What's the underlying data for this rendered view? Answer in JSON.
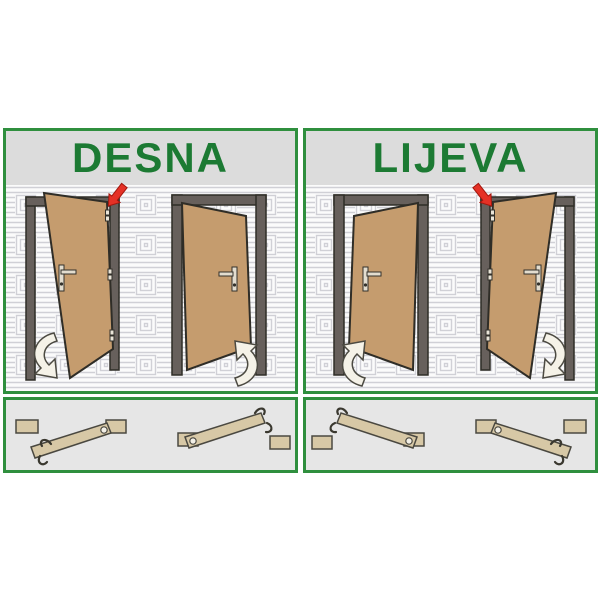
{
  "panels": [
    {
      "id": "desna",
      "title": "DESNA"
    },
    {
      "id": "lijeva",
      "title": "LIJEVA"
    }
  ],
  "colors": {
    "border_green": "#2f8f3e",
    "title_green": "#1c7a33",
    "title_background": "#dcdcdc",
    "bottom_box_background": "#e6e6e6",
    "door_wood": "#c59c6e",
    "door_frame": "#67605c",
    "plank_wood": "#d7c8a6",
    "red_arrow": "#e53126",
    "swing_arrow_fill": "#f5f2e8",
    "wall_pattern_line": "#d0d0d6",
    "wall_pattern_background": "#fbfbfb"
  }
}
